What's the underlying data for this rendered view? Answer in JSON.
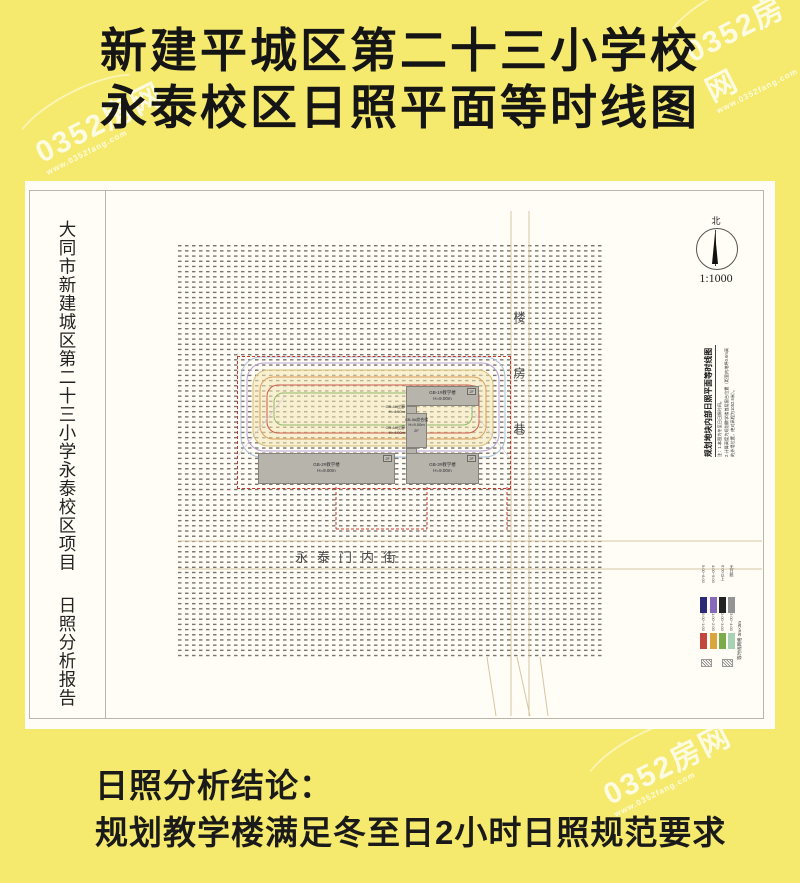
{
  "header": {
    "line1": "新建平城区第二十三小学校",
    "line2": "永泰校区日照平面等时线图"
  },
  "sheet": {
    "side_title": "大同市新建城区第二十三小学永泰校区项目",
    "side_subtitle": "日照分析报告",
    "north_label": "北",
    "scale": "1:1000",
    "right_title": "规划地块内部日照平面等时线图",
    "notes": [
      "注：1.本图为冬至日日照时间。",
      "2.计算高度为规划教学楼首层窗台位置（距室内地坪0.9m高的外墙位置，绝对高程为1052.5米）。"
    ],
    "streets": {
      "bottom": "永泰门内街",
      "right": "楼房巷"
    },
    "buildings": [
      {
        "name": "GB-1#教学楼",
        "height": "H=9.00m",
        "floors": "2F"
      },
      {
        "name": "GB-2#教学楼",
        "height": "H=9.00m",
        "floors": "2F"
      },
      {
        "name": "GB-3#教学楼",
        "height": "H=9.00m",
        "floors": "2F"
      },
      {
        "name": "GB-4#过廊",
        "height": "H=4.50m"
      },
      {
        "name": "GB-5#综合楼",
        "height": "H=9.00m",
        "floors": "2F"
      },
      {
        "name": "GB-6#过廊",
        "height": "H=4.00m"
      }
    ],
    "legend": {
      "caption": "等时线网格 3m×3m",
      "columns": [
        {
          "top_label": "5:00~6:00",
          "top_color": "#2b2a74",
          "bottom_label": "0:00~1:00",
          "bottom_color": "#c4473d"
        },
        {
          "top_label": "4:00~5:00",
          "top_color": "#8769ba",
          "bottom_label": "1:00~2:00",
          "bottom_color": "#d8a63e"
        },
        {
          "top_label": "6:00以上",
          "top_color": "#222222",
          "bottom_label": "2:00~3:00",
          "bottom_color": "#7cab4b"
        },
        {
          "top_label": "无日照",
          "top_color": "#949494",
          "bottom_label": "3:00~4:00",
          "bottom_color": "#a7d2b4"
        }
      ]
    }
  },
  "footer": {
    "line1": "日照分析结论：",
    "line2": "规划教学楼满足冬至日2小时日照规范要求"
  },
  "watermark": {
    "text": "0352房网",
    "url": "www.0352fang.com"
  },
  "colors": {
    "page_bg": "#f5ea6d",
    "sheet_bg": "#fffdf6",
    "boundary_red": "#c8372c",
    "building_fill": "#b7b4ac",
    "building_border": "#85827b",
    "road_tan": "#d8c5a2",
    "grid_dash": "#77756e"
  }
}
